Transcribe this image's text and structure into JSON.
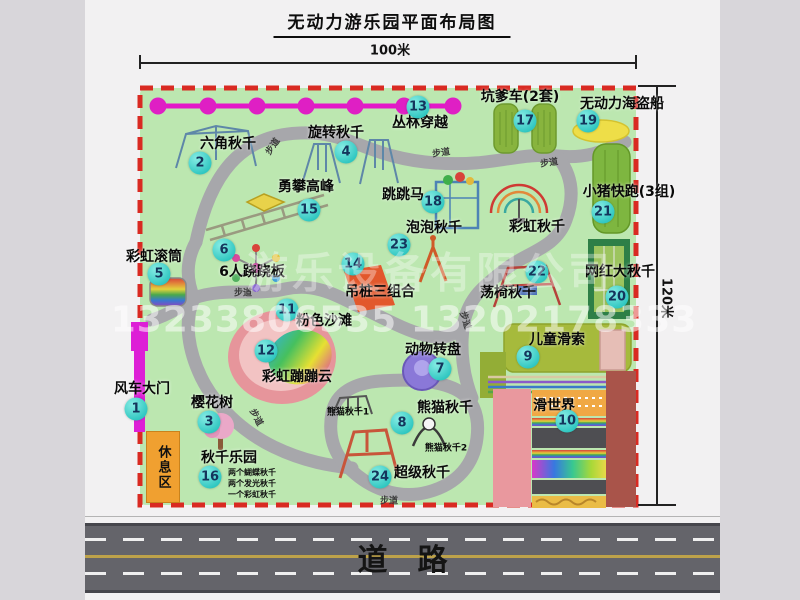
{
  "title": "无动力游乐园平面布局图",
  "dimensions": {
    "top": "100米",
    "right": "120米"
  },
  "road": {
    "label": "道　路"
  },
  "watermark": {
    "company": "游乐设备有限公司",
    "phones": "13233806535 13202178333"
  },
  "rest_area": {
    "label": "休息区"
  },
  "colors": {
    "badge_teal": "#3fd3cd",
    "border_red": "#d92a22",
    "park_green": "#bce7b0",
    "road_gray": "#64646a",
    "gate_magenta": "#dd1fd6",
    "zipline_magenta": "#e318c8",
    "rest_orange": "#f0a030",
    "path_gray": "#a7a7ab"
  },
  "attractions": [
    {
      "num": "1",
      "name": "风车大门",
      "lx": 142,
      "ly": 388,
      "bx": 136,
      "by": 409
    },
    {
      "num": "2",
      "name": "六角秋千",
      "lx": 228,
      "ly": 143,
      "bx": 200,
      "by": 163
    },
    {
      "num": "3",
      "name": "樱花树",
      "lx": 212,
      "ly": 402,
      "bx": 209,
      "by": 422
    },
    {
      "num": "4",
      "name": "旋转秋千",
      "lx": 336,
      "ly": 132,
      "bx": 346,
      "by": 152
    },
    {
      "num": "5",
      "name": "彩虹滚筒",
      "lx": 154,
      "ly": 256,
      "bx": 159,
      "by": 274
    },
    {
      "num": "6",
      "name": "6人跷跷板",
      "lx": 252,
      "ly": 271,
      "bx": 224,
      "by": 250
    },
    {
      "num": "7",
      "name": "动物转盘",
      "lx": 433,
      "ly": 349,
      "bx": 440,
      "by": 369
    },
    {
      "num": "8",
      "name": "熊猫秋千",
      "lx": 445,
      "ly": 407,
      "bx": 402,
      "by": 423
    },
    {
      "num": "9",
      "name": "儿童滑索",
      "lx": 557,
      "ly": 339,
      "bx": 528,
      "by": 357
    },
    {
      "num": "10",
      "name": "滑世界",
      "lx": 554,
      "ly": 405,
      "bx": 567,
      "by": 421
    },
    {
      "num": "11",
      "name": "粉色沙滩",
      "lx": 324,
      "ly": 320,
      "bx": 287,
      "by": 310
    },
    {
      "num": "12",
      "name": "彩虹蹦蹦云",
      "lx": 297,
      "ly": 376,
      "bx": 266,
      "by": 351
    },
    {
      "num": "13",
      "name": "丛林穿越",
      "lx": 420,
      "ly": 122,
      "bx": 418,
      "by": 107
    },
    {
      "num": "14",
      "name": "吊桩三组合",
      "lx": 380,
      "ly": 291,
      "bx": 353,
      "by": 264
    },
    {
      "num": "15",
      "name": "勇攀高峰",
      "lx": 306,
      "ly": 186,
      "bx": 309,
      "by": 210
    },
    {
      "num": "16",
      "name": "秋千乐园",
      "lx": 229,
      "ly": 457,
      "bx": 210,
      "by": 477
    },
    {
      "num": "17",
      "name": "坑爹车(2套)",
      "lx": 520,
      "ly": 96,
      "bx": 525,
      "by": 121
    },
    {
      "num": "18",
      "name": "跳跳马",
      "lx": 403,
      "ly": 194,
      "bx": 433,
      "by": 202
    },
    {
      "num": "19",
      "name": "无动力海盗船",
      "lx": 622,
      "ly": 103,
      "bx": 588,
      "by": 121
    },
    {
      "num": "20",
      "name": "网红大秋千",
      "lx": 620,
      "ly": 271,
      "bx": 617,
      "by": 297
    },
    {
      "num": "21",
      "name": "小猪快跑(3组)",
      "lx": 629,
      "ly": 191,
      "bx": 603,
      "by": 212
    },
    {
      "num": "22",
      "name": "荡椅秋千",
      "lx": 508,
      "ly": 292,
      "bx": 537,
      "by": 272
    },
    {
      "num": "23",
      "name": "泡泡秋千",
      "lx": 434,
      "ly": 227,
      "bx": 399,
      "by": 245
    },
    {
      "num": "24",
      "name": "超级秋千",
      "lx": 422,
      "ly": 472,
      "bx": 380,
      "by": 477
    }
  ],
  "extra_labels": [
    {
      "text": "彩虹秋千",
      "x": 537,
      "y": 226,
      "small": false
    },
    {
      "text": "熊猫秋千1",
      "x": 348,
      "y": 411,
      "small": true
    },
    {
      "text": "熊猫秋千2",
      "x": 446,
      "y": 447,
      "small": true
    }
  ],
  "walkway_labels": [
    {
      "text": "步道",
      "x": 272,
      "y": 146,
      "rot": -55
    },
    {
      "text": "步道",
      "x": 441,
      "y": 152,
      "rot": -8
    },
    {
      "text": "步道",
      "x": 549,
      "y": 162,
      "rot": -8
    },
    {
      "text": "步道",
      "x": 243,
      "y": 292,
      "rot": 0
    },
    {
      "text": "步道",
      "x": 257,
      "y": 417,
      "rot": 62
    },
    {
      "text": "步道",
      "x": 466,
      "y": 320,
      "rot": 72
    },
    {
      "text": "步道",
      "x": 389,
      "y": 500,
      "rot": 0
    }
  ],
  "swing_park_notes": [
    "两个蝴蝶秋千",
    "两个发光秋千",
    "一个彩虹秋千"
  ]
}
